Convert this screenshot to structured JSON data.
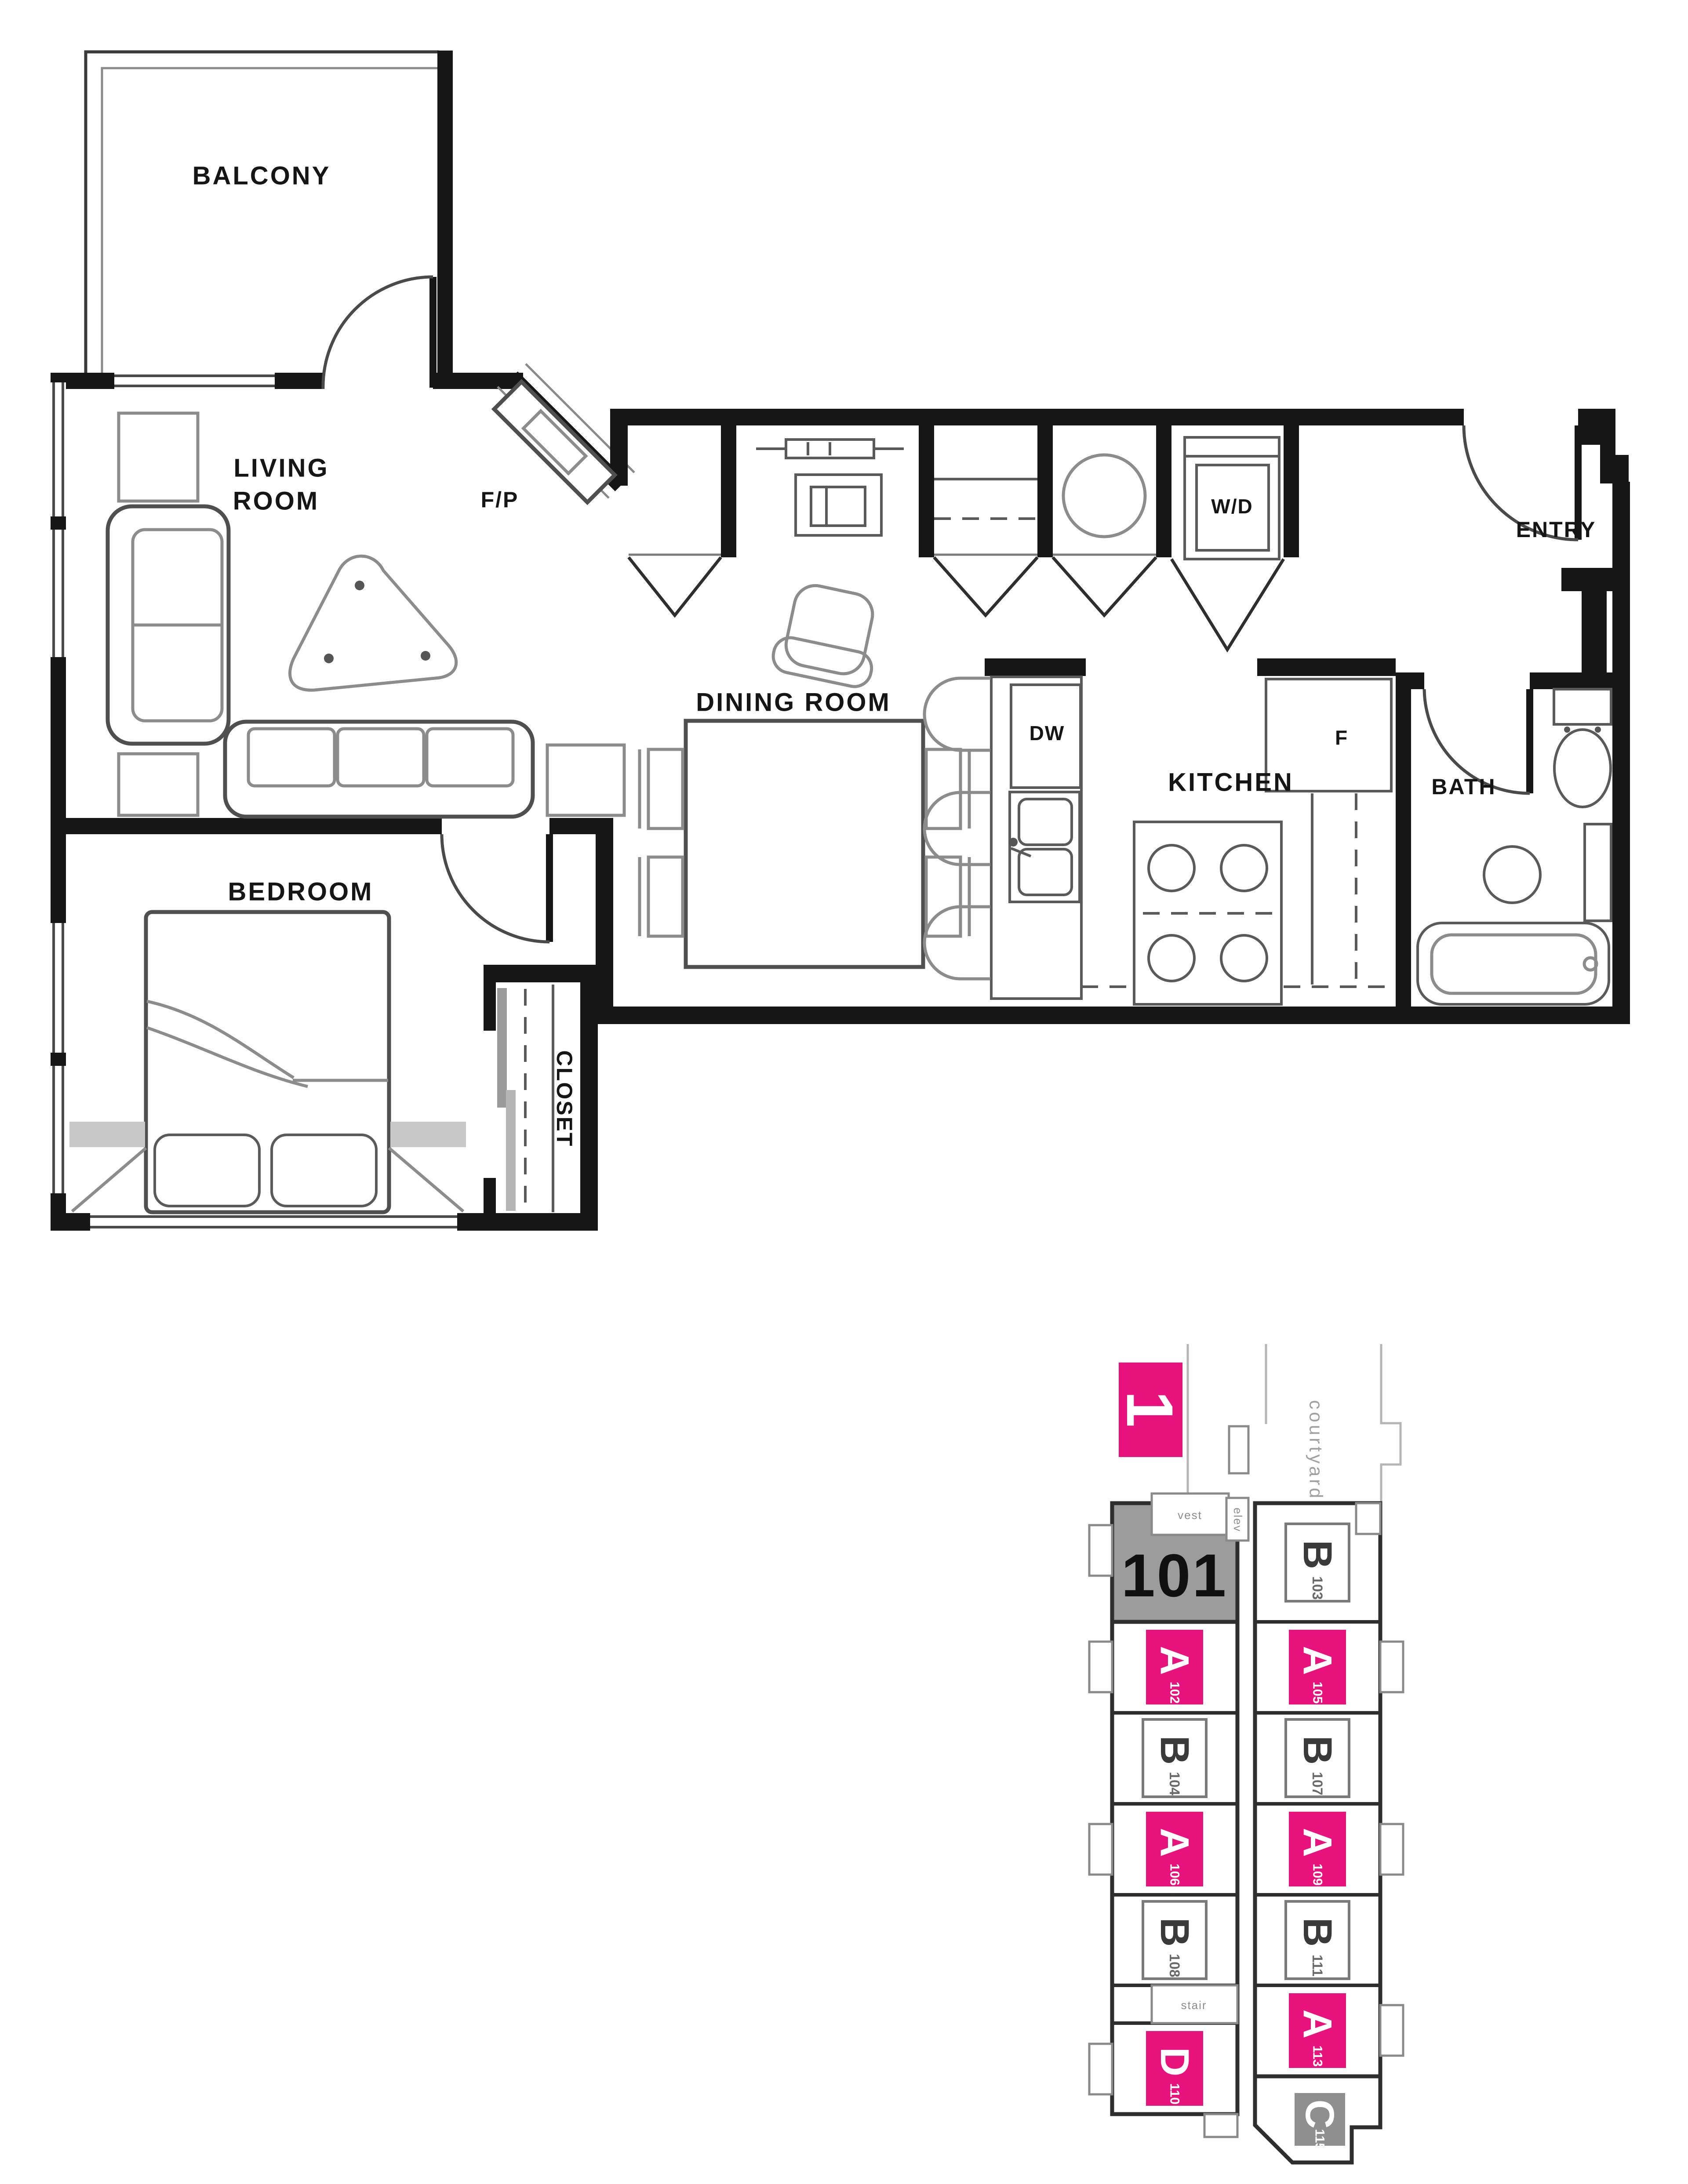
{
  "floor_plan": {
    "labels": {
      "balcony": "BALCONY",
      "living_room": [
        "LIVING",
        "ROOM"
      ],
      "fireplace": "F/P",
      "entry": "ENTRY",
      "dining_room": "DINING ROOM",
      "kitchen": "KITCHEN",
      "bath": "BATH",
      "bedroom": "BEDROOM",
      "closet": "CLOSET",
      "dishwasher": "DW",
      "fridge": "F",
      "washer_dryer": "W/D"
    }
  },
  "key_plan": {
    "level_badge": "1",
    "highlighted_unit": "101",
    "corridor_label": "lobby",
    "site_label": "courtyard",
    "room_labels": {
      "vestibule": "vest",
      "elevator": "elev",
      "stair": "stair"
    },
    "colors": {
      "accent": "#e8127d",
      "highlight_fill": "#9c9c9c",
      "wall": "#161616"
    },
    "left_units": [
      {
        "type": "A",
        "number": "102"
      },
      {
        "type": "B",
        "number": "104"
      },
      {
        "type": "A",
        "number": "106"
      },
      {
        "type": "B",
        "number": "108"
      },
      {
        "type": "D",
        "number": "110"
      }
    ],
    "right_units": [
      {
        "type": "B",
        "number": "103"
      },
      {
        "type": "A",
        "number": "105"
      },
      {
        "type": "B",
        "number": "107"
      },
      {
        "type": "A",
        "number": "109"
      },
      {
        "type": "B",
        "number": "111"
      },
      {
        "type": "A",
        "number": "113"
      },
      {
        "type": "C",
        "number": "115"
      }
    ]
  }
}
